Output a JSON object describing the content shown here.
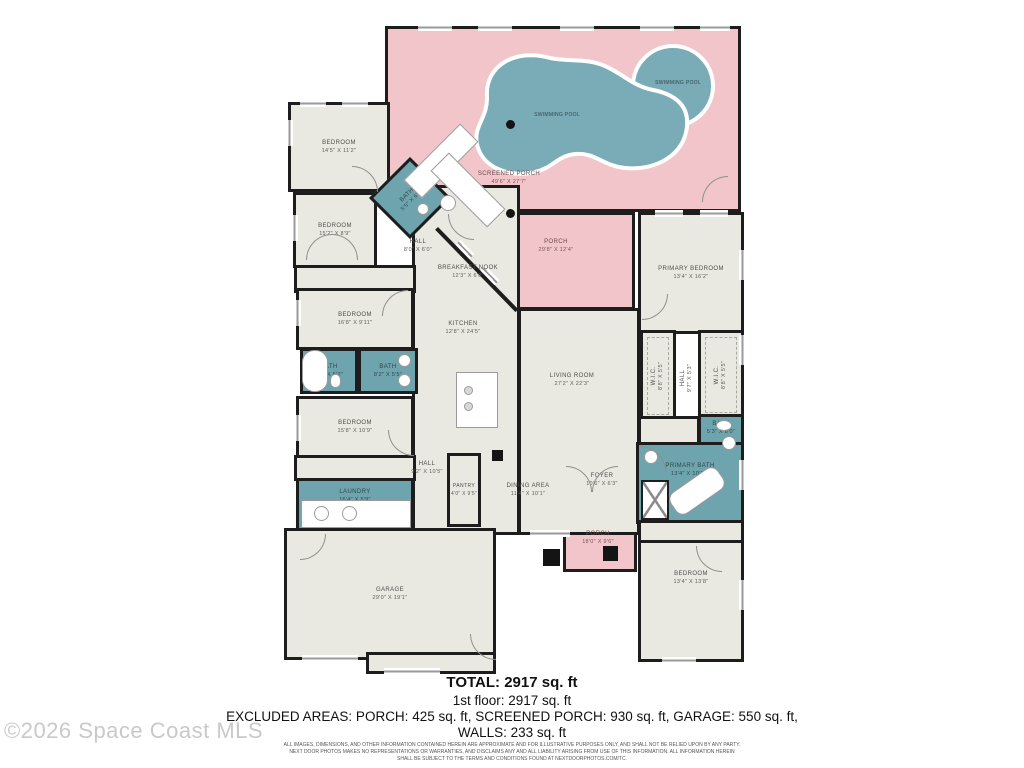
{
  "palette": {
    "porch_pink": "#f1c5c9",
    "pool_teal": "#79acb6",
    "bath_teal": "#6ea4ad",
    "floor_beige": "#eae9e1",
    "wall_black": "#1d1d1d",
    "watermark_gray": "#c9c9c9"
  },
  "rooms": {
    "bedroom_tl": {
      "label": "BEDROOM",
      "dims": "14'5\" X 11'2\""
    },
    "bedroom_2": {
      "label": "BEDROOM",
      "dims": "15'2\" X 8'9\""
    },
    "bath_diag": {
      "label": "BATH",
      "dims": "5'5\" X 6'1\""
    },
    "hall_top": {
      "label": "HALL",
      "dims": "8'0\" X 6'0\""
    },
    "breakfast_nook": {
      "label": "BREAKFAST NOOK",
      "dims": "12'3\" X 6'0\""
    },
    "kitchen": {
      "label": "KITCHEN",
      "dims": "12'8\" X 24'5\""
    },
    "bedroom_3": {
      "label": "BEDROOM",
      "dims": "16'8\" X 9'11\""
    },
    "bath_left": {
      "label": "BATH",
      "dims": "7'6\" X 5'2\""
    },
    "bath_mid": {
      "label": "BATH",
      "dims": "8'2\" X 5'5\""
    },
    "bedroom_4": {
      "label": "BEDROOM",
      "dims": "15'8\" X 10'9\""
    },
    "laundry": {
      "label": "LAUNDRY",
      "dims": "16'4\" X 5'9\""
    },
    "hall_lower": {
      "label": "HALL",
      "dims": "9'2\" X 10'5\""
    },
    "pantry": {
      "label": "PANTRY",
      "dims": "4'0\" X 9'5\""
    },
    "dining": {
      "label": "DINING AREA",
      "dims": "11'4\" X 10'1\""
    },
    "living": {
      "label": "LIVING ROOM",
      "dims": "27'2\" X 22'3\""
    },
    "foyer": {
      "label": "FOYER",
      "dims": "10'6\" X 6'3\""
    },
    "garage": {
      "label": "GARAGE",
      "dims": "29'0\" X 19'1\""
    },
    "screened_porch": {
      "label": "SCREENED PORCH",
      "dims": "49'6\" X 27'7\""
    },
    "porch": {
      "label": "PORCH",
      "dims": "29'8\" X 12'4\""
    },
    "porch_bottom": {
      "label": "PORCH",
      "dims": "18'0\" X 9'6\""
    },
    "primary_bedroom": {
      "label": "PRIMARY BEDROOM",
      "dims": "13'4\" X 16'2\""
    },
    "wic_left": {
      "label": "W.I.C.",
      "dims": "8'8\" X 5'5\""
    },
    "wic_right": {
      "label": "W.I.C.",
      "dims": "8'8\" X 5'5\""
    },
    "hall_wic": {
      "label": "HALL",
      "dims": "9'7\" X 5'3\""
    },
    "bath_small": {
      "label": "BATH",
      "dims": "5'3\" X 8'0\""
    },
    "primary_bath": {
      "label": "PRIMARY BATH",
      "dims": "13'4\" X 10'11\""
    },
    "bedroom_br": {
      "label": "BEDROOM",
      "dims": "13'4\" X 13'8\""
    },
    "pool_main": {
      "label": "SWIMMING POOL"
    },
    "pool_spa": {
      "label": "SWIMMING POOL"
    }
  },
  "summary": {
    "total": "TOTAL: 2917 sq. ft",
    "first_floor": "1st floor: 2917 sq. ft",
    "excluded": "EXCLUDED AREAS: PORCH: 425 sq. ft, SCREENED PORCH: 930 sq. ft, GARAGE: 550 sq. ft,",
    "walls": "WALLS: 233 sq. ft"
  },
  "disclaimer": {
    "line1": "ALL IMAGES, DIMENSIONS, AND OTHER INFORMATION CONTAINED HEREIN ARE APPROXIMATE AND FOR ILLUSTRATIVE PURPOSES ONLY, AND SHALL NOT BE RELIED UPON BY ANY PARTY.",
    "line2": "NEXT DOOR PHOTOS MAKES NO REPRESENTATIONS OR WARRANTIES, AND DISCLAIMS ANY AND ALL LIABILITY ARISING FROM USE OF THIS INFORMATION. ALL INFORMATION HEREIN",
    "line3": "SHALL BE SUBJECT TO THE TERMS AND CONDITIONS FOUND AT NEXTDOORPHOTOS.COM/TC."
  },
  "watermark": {
    "text": "©2026 Space Coast MLS"
  }
}
